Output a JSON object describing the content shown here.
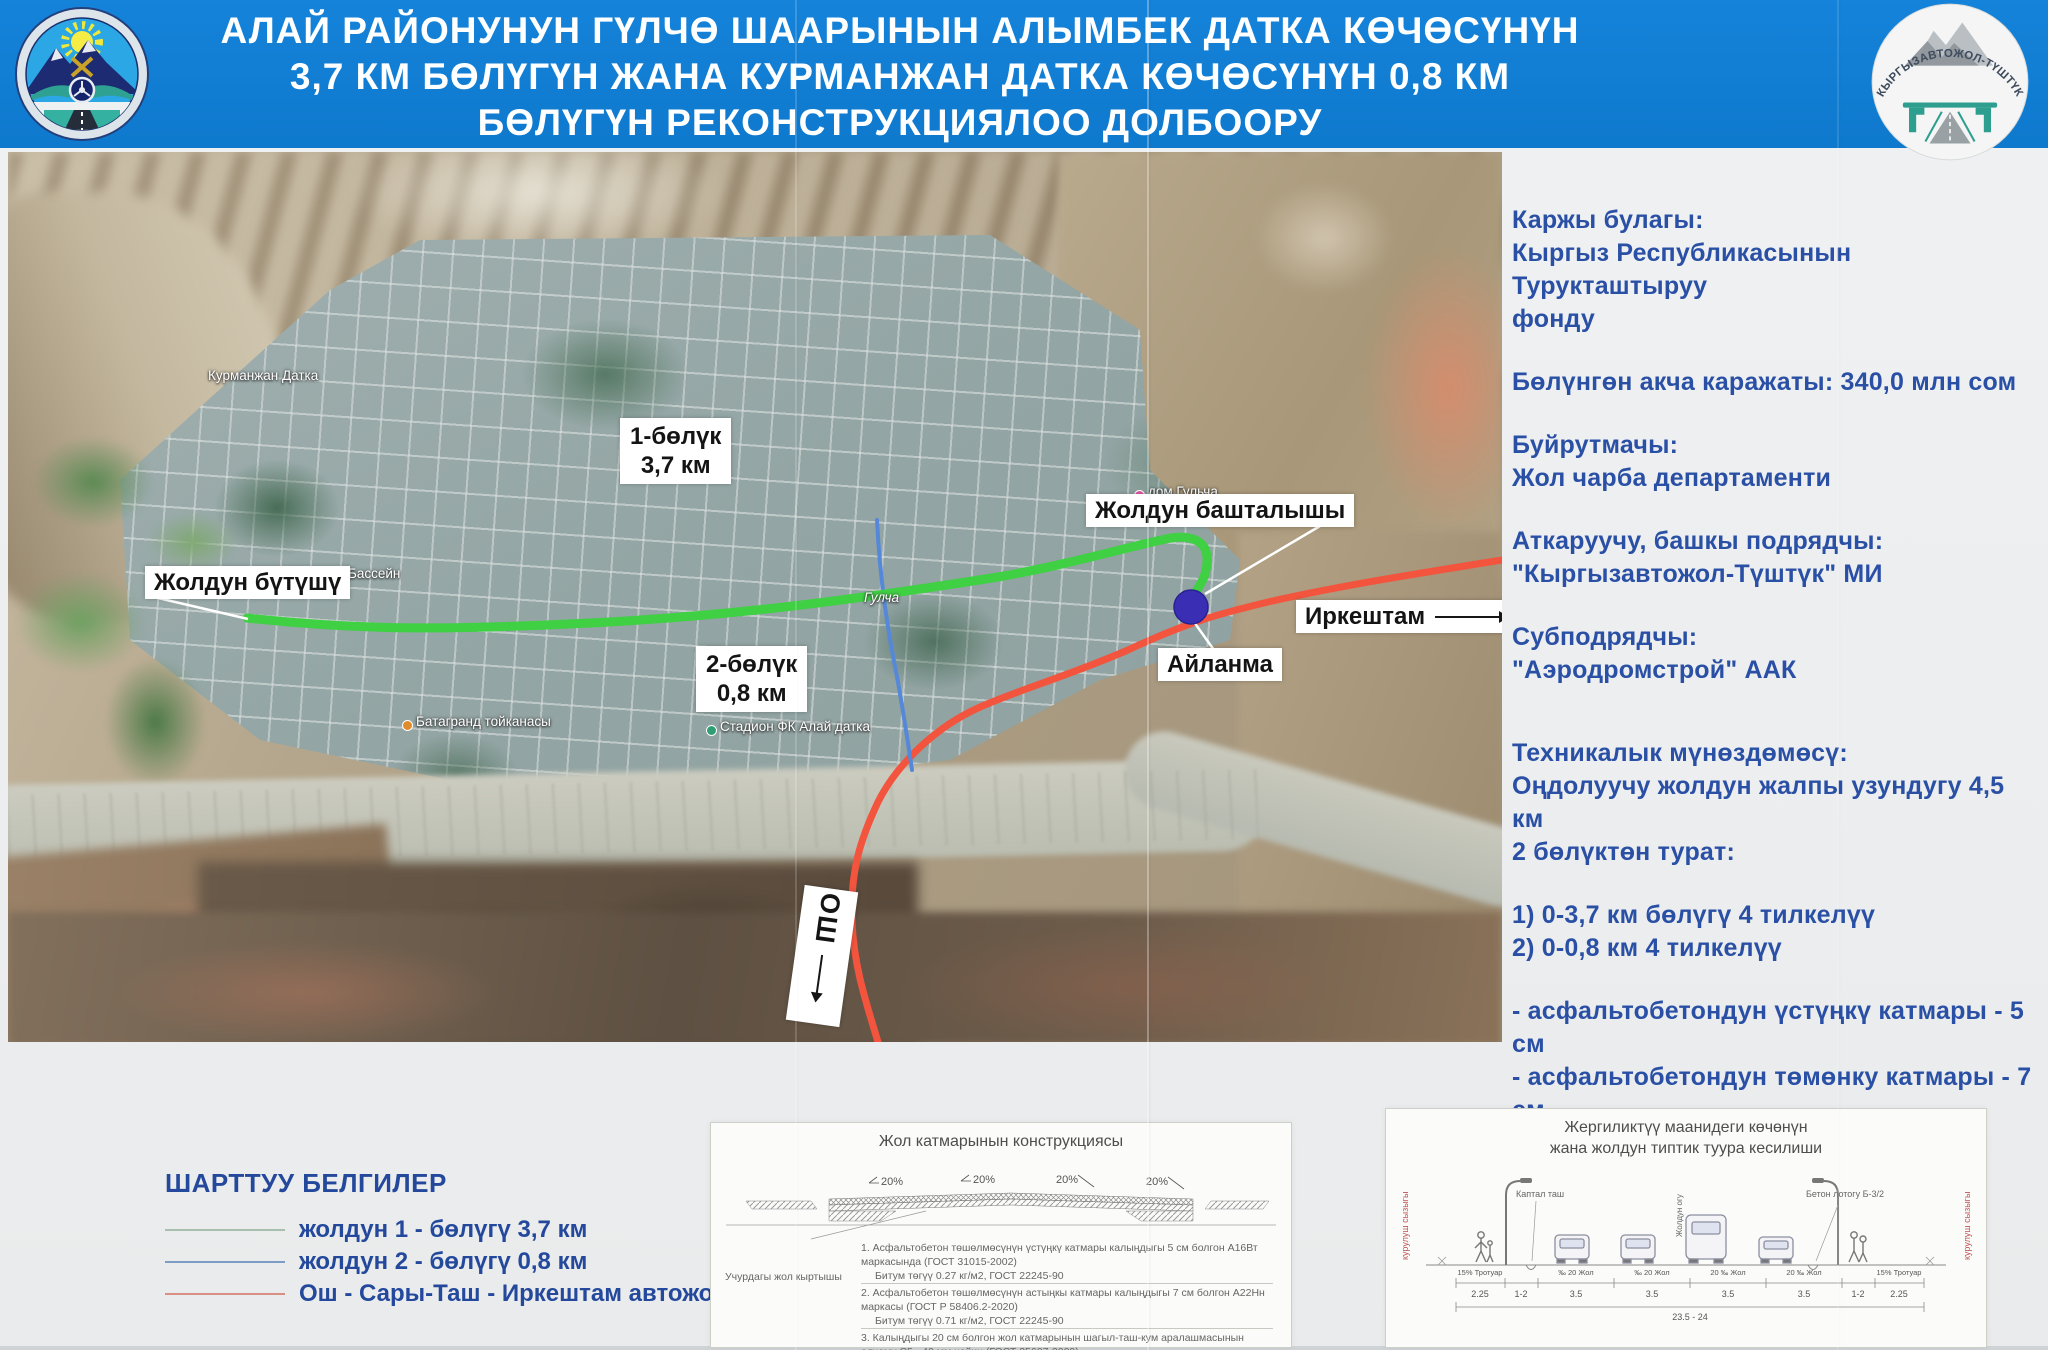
{
  "header": {
    "title_lines": [
      "АЛАЙ РАЙОНУНУН ГҮЛЧӨ ШААРЫНЫН АЛЫМБЕК ДАТКА КӨЧӨСҮНҮН",
      "3,7 КМ БӨЛҮГҮН ЖАНА КУРМАНЖАН ДАТКА КӨЧӨСҮНҮН 0,8 КМ",
      "БӨЛҮГҮН РЕКОНСТРУКЦИЯЛОО ДОЛБООРУ"
    ],
    "right_logo_text": "КЫРГЫЗАВТОЖОЛ-ТҮШТҮК",
    "colors": {
      "header_bg": "#1583da",
      "title_text": "#ffffff"
    }
  },
  "map": {
    "labels": {
      "section1_line1": "1-бөлүк",
      "section1_line2": "3,7 км",
      "section2_line1": "2-бөлүк",
      "section2_line2": "0,8 км",
      "road_start": "Жолдун башталышы",
      "road_end": "Жолдун бүтүшү",
      "roundabout": "Айланма",
      "direction_irkeshtam": "Иркештам",
      "direction_osh": "ОШ"
    },
    "poi_labels": [
      "Курманжан Датка",
      "Бассейн",
      "Гулча",
      "Батагранд тойканасы",
      "Стадион ФК Алай датка",
      "дом Гульча"
    ],
    "route_colors": {
      "section1_green": "#3fd044",
      "section2_blue": "#5588d8",
      "highway_red": "#f2543e",
      "roundabout_marker": "#3a2fb4"
    }
  },
  "info_panel": {
    "text_color": "#2a50a6",
    "blocks": [
      [
        "Каржы булагы:",
        "Кыргыз Республикасынын Турукташтыруу",
        "фонду"
      ],
      [
        "Бөлүнгөн акча каражаты: 340,0 млн сом"
      ],
      [
        "Буйрутмачы:",
        "Жол чарба департаменти"
      ],
      [
        "Аткаруучу, башкы подрядчы:",
        "\"Кыргызавтожол-Түштүк\" МИ"
      ],
      [
        "Субподрядчы:",
        "\"Аэродромстрой\" ААК"
      ],
      [
        "Техникалык мүнөздөмөсү:",
        "Оңдолуучу жолдун жалпы узундугу 4,5 км",
        "2 бөлүктөн турат:"
      ],
      [
        "1) 0-3,7 км бөлүгү 4 тилкелүү",
        "2) 0-0,8 км 4 тилкелүү"
      ],
      [
        "- асфальтобетондун үстүңкү катмары - 5 см",
        "- асфальтобетондун төмөнку катмары - 7 см",
        "- тротуарлардын узундугу - 9,0 км",
        "- лотокторду орнотуу - 9000 метр",
        "- жарыктандыруу - 9000 метр"
      ]
    ]
  },
  "legend": {
    "title": "ШАРТТУУ БЕЛГИЛЕР",
    "items": [
      {
        "label": "жолдун 1 - бөлүгү 3,7 км",
        "color": "#a8bfae"
      },
      {
        "label": "жолдун 2 - бөлүгү 0,8 км",
        "color": "#7d9cc6"
      },
      {
        "label": "Ош - Сары-Таш - Иркештам автожолу",
        "color": "#d98f84"
      }
    ]
  },
  "diagram_road_layers": {
    "title": "Жол катмарынын конструкциясы",
    "slope_labels": [
      "20%",
      "20%",
      "20%",
      "20%"
    ],
    "existing_road_label": "Учурдагы жол кыртышы",
    "notes": [
      "1. Асфальтобетон төшөлмөсүнүн үстүңкү катмары калыңдыгы 5 см болгон А16Вт маркасында (ГОСТ 31015-2002)",
      "Битум төгүү 0.27 кг/м2, ГОСТ 22245-90",
      "2. Асфальтобетон төшөлмөсүнүн астыңкы катмары калыңдыгы 7 см болгон А22Нн маркасы (ГОСТ Р 58406.2-2020)",
      "Битум төгүү 0.71 кг/м2, ГОСТ 22245-90",
      "3. Калыңдыгы 20 см болгон жол катмарынын шагыл-таш-кум аралашмасынын өлчөмү С5 - 40 мм чейин (ГОСТ 25607-2009)",
      "4. Калыңдыгы 25 см болгон жол катмарынын кум-шагыл аралашмасынын өлчөмү С4 - 80 мм чейин (ГОСТ 25607-2009)"
    ]
  },
  "diagram_cross_section": {
    "title_lines": [
      "Жергиликтүү  маанидеги көчөнүн",
      "жана жолдун типтик туура кесилиши"
    ],
    "left_boundary_label": "курулуш сызыгы",
    "right_boundary_label": "курулуш сызыгы",
    "curb_label": "Каптал таш",
    "gutter_label": "Бетон лотогу Б-3/2",
    "axis_label": "Жолдун огу",
    "lane_labels": [
      "15% Тротуар",
      "‰ 20 Жол",
      "‰ 20 Жол",
      "20 ‰ Жол",
      "20 ‰ Жол",
      "15% Тротуар"
    ],
    "dimensions": [
      "2.25",
      "1-2",
      "3.5",
      "3.5",
      "3.5",
      "3.5",
      "1-2",
      "2.25"
    ],
    "total_width": "23.5 - 24"
  }
}
